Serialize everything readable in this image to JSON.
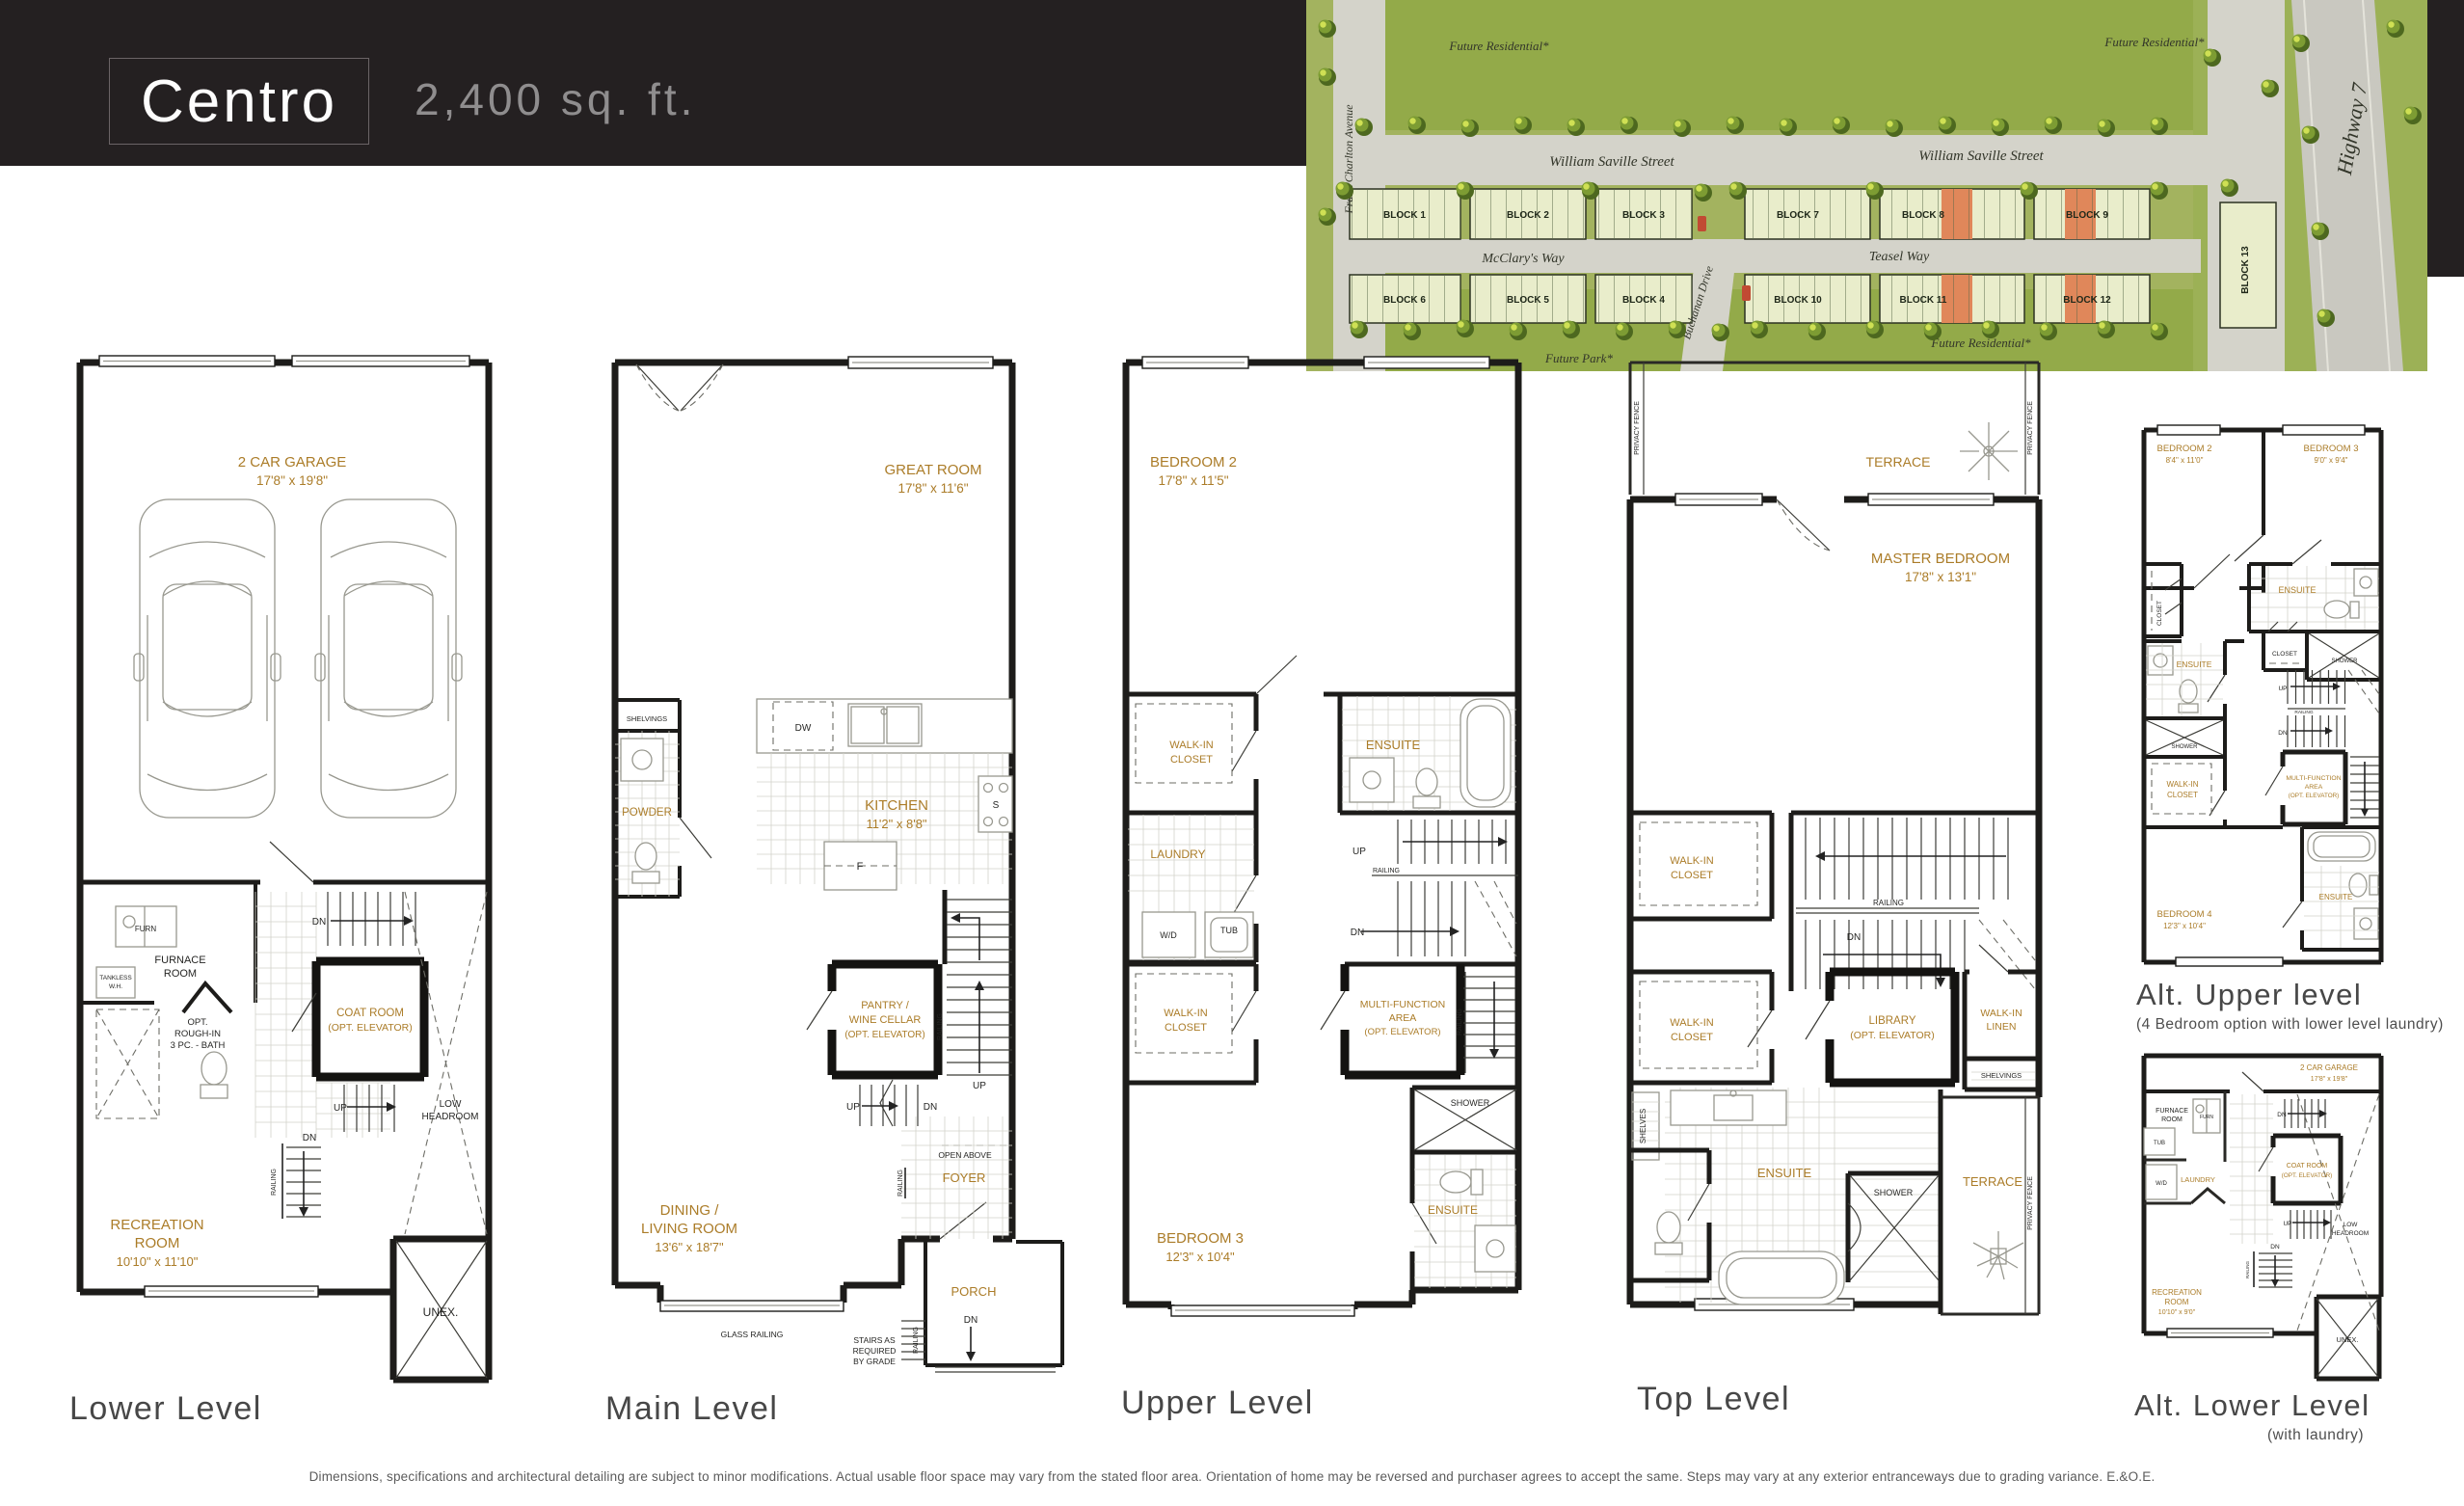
{
  "header": {
    "title": "Centro",
    "sqft": "2,400 sq. ft."
  },
  "siteplan": {
    "future_residential_1": "Future Residential*",
    "future_residential_2": "Future Residential*",
    "future_residential_3": "Future Residential*",
    "future_park": "Future Park*",
    "william_saville_1": "William Saville Street",
    "william_saville_2": "William Saville Street",
    "mcclarys_way": "McClary's Way",
    "teasel_way": "Teasel Way",
    "frank_charlton": "Frank Charlton Avenue",
    "buchanan": "Buchanan Drive",
    "highway7": "Highway 7",
    "blocks": {
      "b1": "BLOCK 1",
      "b2": "BLOCK 2",
      "b3": "BLOCK 3",
      "b4": "BLOCK 4",
      "b5": "BLOCK 5",
      "b6": "BLOCK 6",
      "b7": "BLOCK 7",
      "b8": "BLOCK 8",
      "b9": "BLOCK 9",
      "b10": "BLOCK 10",
      "b11": "BLOCK 11",
      "b12": "BLOCK 12",
      "b13": "BLOCK 13"
    }
  },
  "plans": {
    "lower": {
      "caption": "Lower Level",
      "labels": {
        "garage1": "2 CAR GARAGE",
        "garage2": "17'8\" x 19'8\"",
        "furn": "FURN",
        "furnace1": "FURNACE",
        "furnace2": "ROOM",
        "tankless1": "TANKLESS",
        "tankless2": "W.H.",
        "optbath1": "OPT.",
        "optbath2": "ROUGH-IN",
        "optbath3": "3 PC. - BATH",
        "coat1": "COAT ROOM",
        "coat2": "(OPT. ELEVATOR)",
        "dn1": "DN",
        "up": "UP",
        "dn2": "DN",
        "railing": "RAILING",
        "low1": "LOW",
        "low2": "HEADROOM",
        "rec1": "RECREATION",
        "rec2": "ROOM",
        "rec3": "10'10\" x 11'10\"",
        "unex": "UNEX."
      }
    },
    "main": {
      "caption": "Main Level",
      "labels": {
        "great1": "GREAT ROOM",
        "great2": "17'8\" x 11'6\"",
        "shelvings": "SHELVINGS",
        "powder": "POWDER",
        "dw": "DW",
        "s": "S",
        "f": "F",
        "kitchen1": "KITCHEN",
        "kitchen2": "11'2\" x 8'8\"",
        "pantry1": "PANTRY /",
        "pantry2": "WINE CELLAR",
        "pantry3": "(OPT. ELEVATOR)",
        "railing1": "RAILING",
        "up1": "UP",
        "up2": "UP",
        "dn": "DN",
        "open_above": "OPEN ABOVE",
        "foyer": "FOYER",
        "railing2": "RAILING",
        "dining1": "DINING /",
        "dining2": "LIVING ROOM",
        "dining3": "13'6\" x 18'7\"",
        "glass_railing": "GLASS RAILING",
        "porch": "PORCH",
        "dn2": "DN",
        "railing3": "RAILING",
        "stairs1": "STAIRS AS",
        "stairs2": "REQUIRED",
        "stairs3": "BY GRADE"
      }
    },
    "upper": {
      "caption": "Upper Level",
      "labels": {
        "bed2_1": "BEDROOM 2",
        "bed2_2": "17'8\" x 11'5\"",
        "wic1_1": "WALK-IN",
        "wic1_2": "CLOSET",
        "ensuite1": "ENSUITE",
        "laundry": "LAUNDRY",
        "wd": "W/D",
        "tub": "TUB",
        "up": "UP",
        "railing1": "RAILING",
        "dn": "DN",
        "wic2_1": "WALK-IN",
        "wic2_2": "CLOSET",
        "multi1": "MULTI-FUNCTION",
        "multi2": "AREA",
        "multi3": "(OPT. ELEVATOR)",
        "railing2": "RAILING",
        "shower": "SHOWER",
        "ensuite2": "ENSUITE",
        "bed3_1": "BEDROOM 3",
        "bed3_2": "12'3\" x 10'4\""
      }
    },
    "top": {
      "caption": "Top Level",
      "labels": {
        "terrace1": "TERRACE",
        "privacy1": "PRIVACY FENCE",
        "privacy2": "PRIVACY FENCE",
        "master1": "MASTER BEDROOM",
        "master2": "17'8\" x 13'1\"",
        "wic1_1": "WALK-IN",
        "wic1_2": "CLOSET",
        "railing": "RAILING",
        "dn": "DN",
        "wic2_1": "WALK-IN",
        "wic2_2": "CLOSET",
        "library1": "LIBRARY",
        "library2": "(OPT. ELEVATOR)",
        "linen1": "WALK-IN",
        "linen2": "LINEN",
        "shelvings": "SHELVINGS",
        "shelves": "SHELVES",
        "ensuite": "ENSUITE",
        "shower": "SHOWER",
        "terrace2": "TERRACE",
        "privacy3": "PRIVACY FENCE"
      }
    },
    "altupper": {
      "caption": "Alt. Upper level",
      "subcaption": "(4 Bedroom option with lower level laundry)",
      "labels": {
        "bed2_1": "BEDROOM 2",
        "bed2_2": "8'4\" x 11'0\"",
        "bed3_1": "BEDROOM 3",
        "bed3_2": "9'0\" x 9'4\"",
        "ensuite1": "ENSUITE",
        "shower1": "SHOWER",
        "closet1": "CLOSET",
        "closet2": "CLOSET",
        "ensuite2": "ENSUITE",
        "shower2": "SHOWER",
        "wic1": "WALK-IN",
        "wic2": "CLOSET",
        "up": "UP",
        "railing": "RAILING",
        "dn": "DN",
        "multi1": "MULTI-FUNCTION",
        "multi2": "AREA",
        "multi3": "(OPT. ELEVATOR)",
        "bed4_1": "BEDROOM 4",
        "bed4_2": "12'3\" x 10'4\"",
        "ensuite3": "ENSUITE"
      }
    },
    "altlower": {
      "caption": "Alt. Lower Level",
      "subcaption": "(with laundry)",
      "labels": {
        "garage1": "2 CAR GARAGE",
        "garage2": "17'8\" x 19'8\"",
        "furnace1": "FURNACE",
        "furnace2": "ROOM",
        "furn": "FURN",
        "tub": "TUB",
        "wd": "W/D",
        "laundry": "LAUNDRY",
        "dn1": "DN",
        "coat1": "COAT ROOM",
        "coat2": "(OPT. ELEVATOR)",
        "up": "UP",
        "dn2": "DN",
        "railing": "RAILING",
        "low1": "LOW",
        "low2": "HEADROOM",
        "rec1": "RECREATION",
        "rec2": "ROOM",
        "rec3": "10'10\" x 9'0\"",
        "unex": "UNEX."
      }
    }
  },
  "disclaimer": "Dimensions, specifications and architectural detailing are subject to minor modifications. Actual usable floor space may vary from the stated floor area. Orientation of home may be reversed and purchaser agrees to accept the same. Steps may vary at any exterior entranceways due to grading variance. E.&O.E."
}
